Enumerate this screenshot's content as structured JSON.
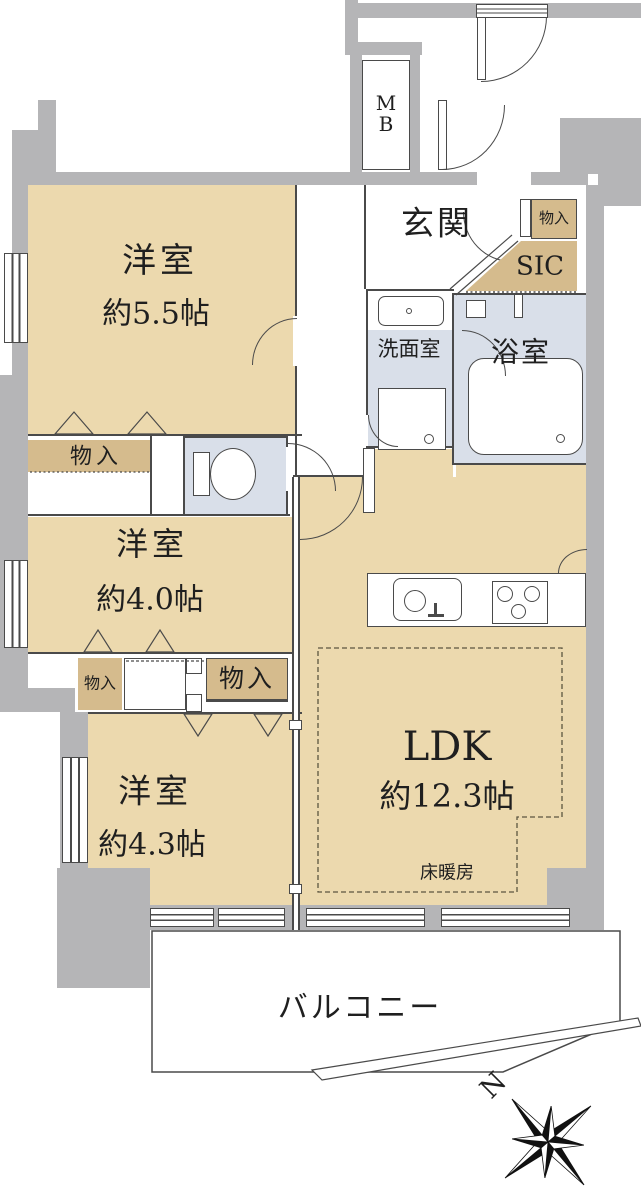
{
  "plan": {
    "rooms": {
      "bedroom1_name": "洋室",
      "bedroom1_size": "約5.5帖",
      "bedroom2_name": "洋室",
      "bedroom2_size": "約4.0帖",
      "bedroom3_name": "洋室",
      "bedroom3_size": "約4.3帖",
      "ldk_name": "LDK",
      "ldk_size": "約12.3帖",
      "entrance": "玄関",
      "shoe_closet": "SIC",
      "washroom": "洗面室",
      "bathroom": "浴室",
      "balcony": "バルコニー",
      "floor_heating": "床暖房",
      "storage": "物入",
      "meter_box": "MB",
      "north": "N"
    },
    "colors": {
      "room_fill": "#ecd9ae",
      "closet_fill": "#d5bb8d",
      "wet_fill": "#d9dfe9",
      "wall": "#b5b5b7",
      "line": "#4a4a4a",
      "dash": "#5c5640"
    }
  }
}
